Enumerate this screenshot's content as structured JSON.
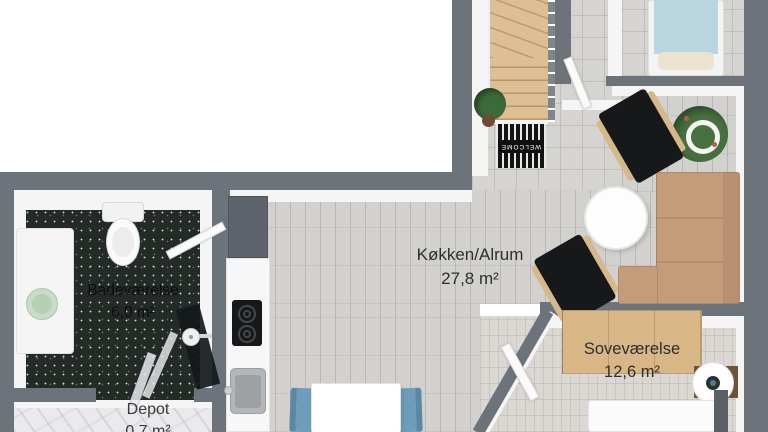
{
  "rooms": [
    {
      "name": "Køkken/Alrum",
      "area": "27,8 m²"
    },
    {
      "name": "Soveværelse",
      "area": "12,6 m²"
    },
    {
      "name": "Badeværelse",
      "area": "6,0 m²"
    },
    {
      "name": "Depot",
      "area": "0,7 m²"
    }
  ],
  "doormat": {
    "text": "WELCOME"
  },
  "colors": {
    "wall": "#6d737b",
    "floor_main": "#d3d1ce",
    "floor_bathroom": "#242b27",
    "floor_bedroom": "#dbd8d4",
    "floor_depot": "#ebe9ec",
    "stairs_wood": "#debf94",
    "sofa": "#c39c7a",
    "wardrobe_wood": "#d8b685",
    "dining_chair_blue": "#6e9db9",
    "bed_mattress_blue": "#b9d6e0",
    "plant_green": "#47703f"
  }
}
